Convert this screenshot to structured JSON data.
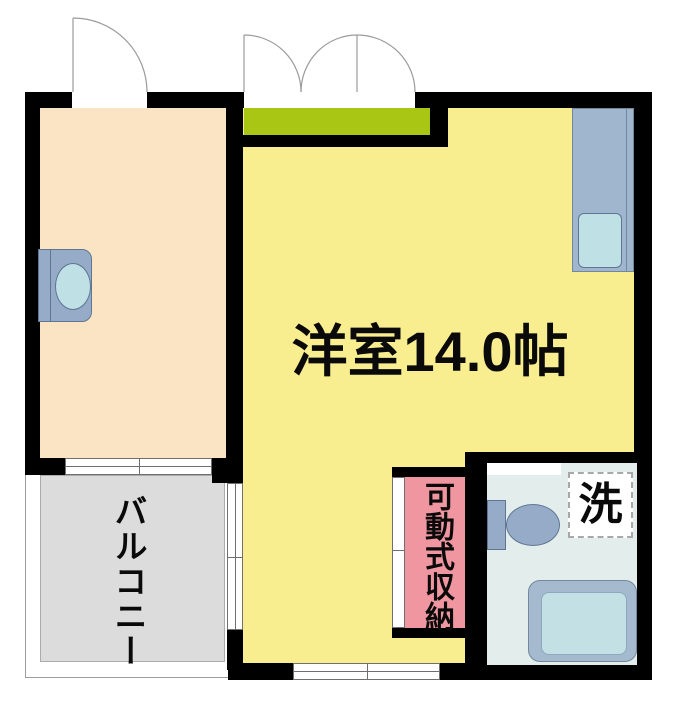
{
  "floor_plan": {
    "main_room": {
      "label": "洋室14.0帖"
    },
    "balcony": {
      "label": "バルコニー"
    },
    "storage": {
      "label": "可動式収納"
    },
    "laundry": {
      "label": "洗"
    },
    "colors": {
      "wall": "#000000",
      "main_room_fill": "#F8EE8F",
      "sub_room_fill": "#FAE4C3",
      "balcony_fill": "#DCDCDC",
      "storage_fill": "#F096A0",
      "bathroom_fill": "#E2EDEC",
      "entrance_sill_green": "#A9C614",
      "fixture_blue": "#95ABC8",
      "fixture_light_blue": "#BFE0E4"
    },
    "fixtures": [
      "kitchen-counter",
      "sink",
      "toilet",
      "bathtub",
      "washer",
      "laundry-space",
      "single-door",
      "double-door"
    ]
  }
}
